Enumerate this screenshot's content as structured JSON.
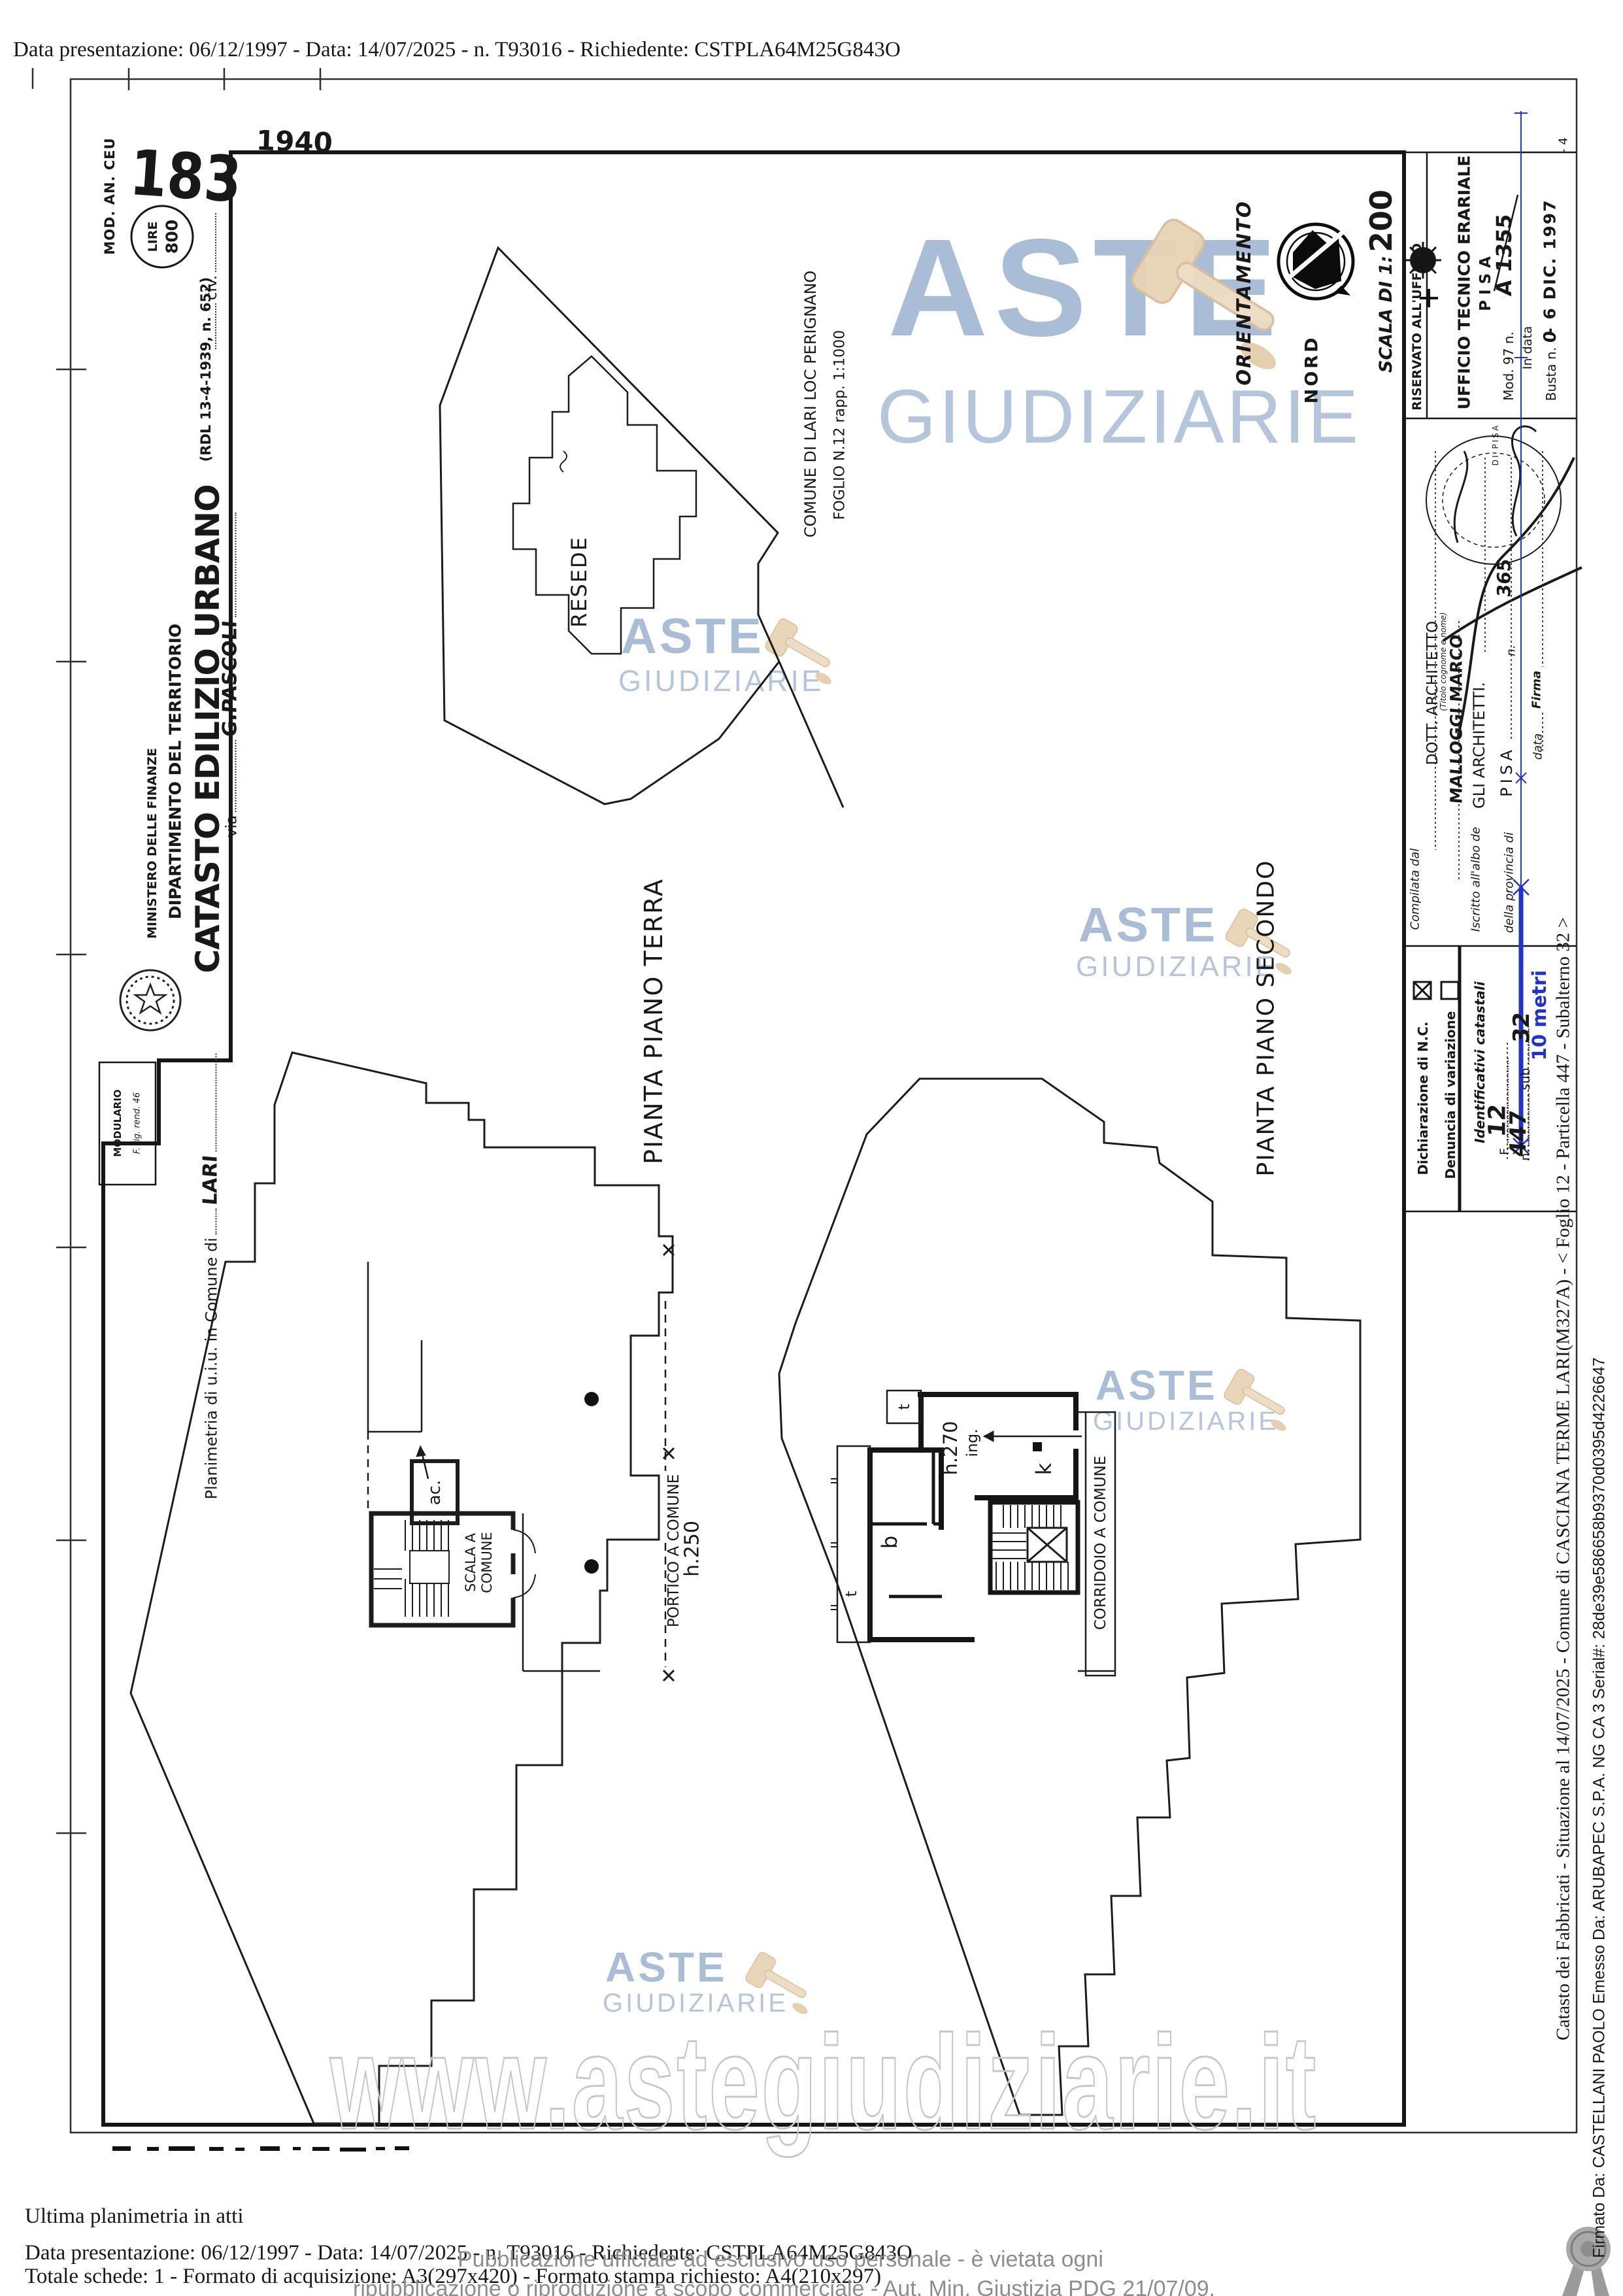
{
  "header": {
    "top_line": "Data presentazione: 06/12/1997 - Data: 14/07/2025 - n. T93016 - Richiedente: CSTPLA64M25G843O"
  },
  "stamps": {
    "mod_an": "MOD. AN. CEU",
    "numero": "183",
    "lire": "LIRE",
    "lire_value": "800",
    "anno": "1940",
    "riservato": "RISERVATO ALL'UFFICIO",
    "stamp_rim": "DI PISA"
  },
  "intestazione": {
    "ministero": "MINISTERO DELLE FINANZE",
    "dipartimento": "DIPARTIMENTO DEL TERRITORIO",
    "catasto": "CATASTO EDILIZIO URBANO",
    "rdl": "(RDL 13-4-1939, n. 652)",
    "modulario": "MODULARIO",
    "modulario_sub": "F. rig. rend. 46",
    "planimetria": "Planimetria di u.i.u. in Comune di",
    "comune": "LARI",
    "via": "via",
    "via_value": "G.PASCOLI",
    "civ": "civ."
  },
  "mappa": {
    "resede": "RESEDE",
    "riga1": "COMUNE DI LARI LOC PERIGNANO",
    "riga2": "FOGLIO N.12 rapp. 1:1000"
  },
  "orientamento": {
    "label": "ORIENTAMENTO",
    "nord": "NORD",
    "scala": "SCALA DI 1:",
    "scala_value": "200"
  },
  "ufficio": {
    "nome": "UFFICIO TECNICO ERARIALE",
    "citta": "PISA",
    "mod97": "Mod. 97 n.",
    "mod97_value": "A 1355",
    "in_data": "In data",
    "timbro_data": "- 6 DIC. 1997",
    "busta": "Busta n.",
    "busta_value": "0",
    "nota": "- 4"
  },
  "compilatore": {
    "compilata": "Compilata dal",
    "titolo": "DOTT. ARCHITETTO",
    "titolo_nota": "(Titolo cognome e nome)",
    "nome": "MALLOGGI MARCO",
    "iscritto": "Iscritto all'albo de",
    "albo": "GLI ARCHITETTI.",
    "provincia": "della provincia di",
    "provincia_value": "PISA",
    "n": "n.",
    "n_value": "365",
    "data": "data",
    "firma": "Firma"
  },
  "dichiarazione": {
    "nc": "Dichiarazione di N.C.",
    "variazione": "Denuncia di variazione",
    "identificativi": "Identificativi catastali",
    "f": "F.",
    "f_value": "12",
    "n": "n.",
    "n_value": "447",
    "sub": "sub",
    "sub_value": "32"
  },
  "piante": {
    "terra": "PIANTA PIANO TERRA",
    "secondo": "PIANTA PIANO SECONDO",
    "portico": "PORTICO A COMUNE",
    "portico_h": "h.250",
    "scala_a": "SCALA A",
    "comune": "COMUNE",
    "ac": "ac.",
    "corridoio": "CORRIDOIO A COMUNE",
    "h270": "h.270",
    "ing": "ing.",
    "k": "k",
    "b": "b",
    "t": "t"
  },
  "annotazioni": {
    "misura": "10 metri"
  },
  "watermark": {
    "aste": "ASTE",
    "giudiziarie": "GIUDIZIARIE",
    "url": "www.astegiudiziarie.it",
    "disc1": "Pubblicazione ufficiale ad esclusivo uso personale - è vietata ogni",
    "disc2": "ripubblicazione o riproduzione a scopo commerciale - Aut. Min. Giustizia PDG 21/07/09."
  },
  "footer": {
    "riga1": "Ultima planimetria in atti",
    "riga2": "Data presentazione: 06/12/1997 - Data: 14/07/2025 - n. T93016 - Richiedente: CSTPLA64M25G843O",
    "riga3": "Totale schede: 1 - Formato di acquisizione: A3(297x420) - Formato stampa richiesto: A4(210x297)"
  },
  "lato": {
    "catasto": "Catasto dei Fabbricati - Situazione al 14/07/2025 - Comune di CASCIANA TERME LARI(M327A) - < Foglio 12 - Particella 447 - Subalterno 32 >",
    "firmato": "Firmato Da: CASTELLANI PAOLO Emesso Da: ARUBAPEC S.P.A. NG CA 3 Serial#: 28de39e586658b9370d0395d4226647"
  },
  "colors": {
    "watermark_blue": "#a9bdd7",
    "gavel_tan": "#e8d4b5",
    "annotation_blue": "#2233cc",
    "url_outline_gray": "#c8c8c8",
    "disclaimer_gray": "#8e8e8e"
  }
}
